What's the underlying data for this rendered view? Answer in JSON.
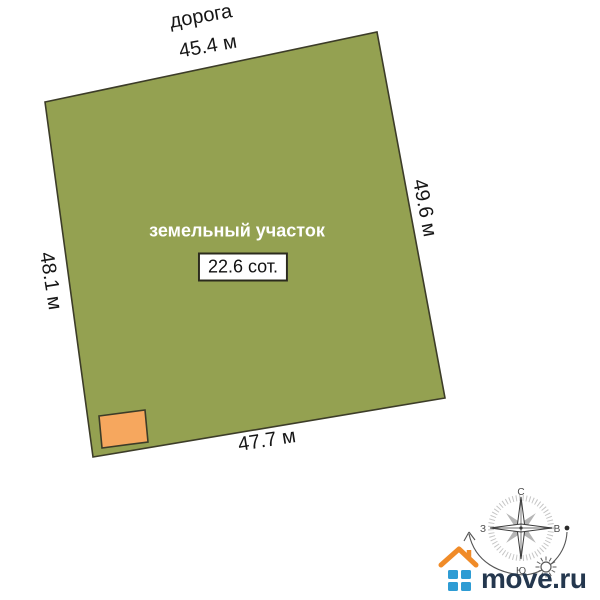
{
  "figure": {
    "road_label": "дорога",
    "plot_label": "земельный участок",
    "area_value": "22.6 сот.",
    "dimensions": {
      "top": "45.4 м",
      "right": "49.6 м",
      "left": "48.1 м",
      "bottom": "47.7 м"
    },
    "colors": {
      "plot_fill": "#94a151",
      "plot_stroke": "#3c3c28",
      "building_fill": "#f6a75e",
      "building_stroke": "#3c3c28"
    }
  },
  "compass": {
    "north_label": "С",
    "south_label": "Ю",
    "west_label": "З",
    "east_label": "В"
  },
  "logo": {
    "text": "move.ru",
    "roof_color": "#f08b28",
    "window_color": "#2e9cd4",
    "text_color": "#24374e"
  }
}
